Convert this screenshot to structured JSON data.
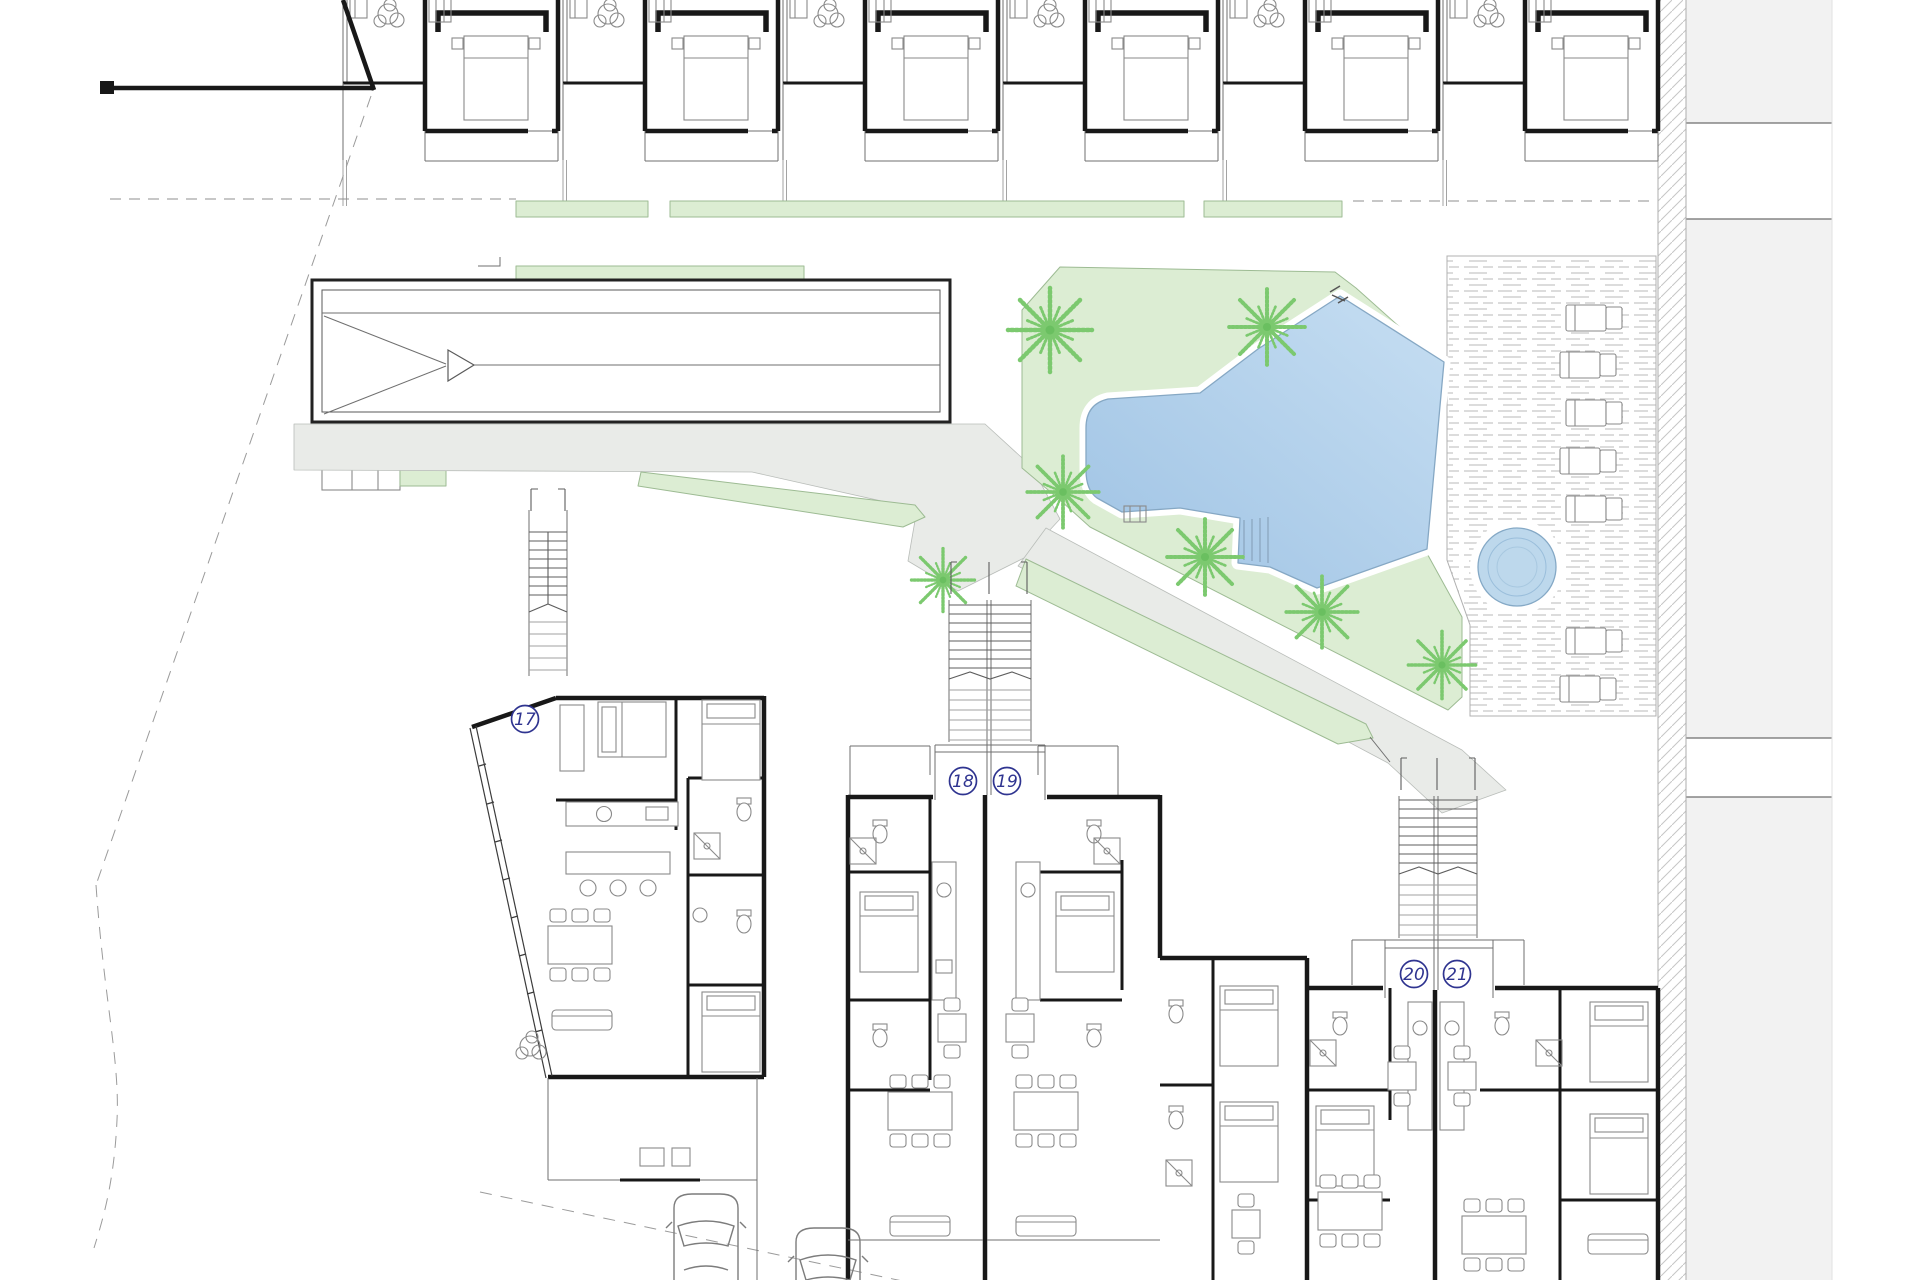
{
  "plan": {
    "unit_labels": [
      {
        "number": "17"
      },
      {
        "number": "18"
      },
      {
        "number": "19"
      },
      {
        "number": "20"
      },
      {
        "number": "21"
      }
    ]
  },
  "palette": {
    "lawn": "#dcedd3",
    "path": "#e9ebe8",
    "palm": "#7cc96f",
    "pool_light": "#c6def2",
    "pool_dark": "#9fc3e4",
    "spa": "#bdd8ec",
    "label_ink": "#2f3490",
    "wall_ink": "#181818",
    "deck_line": "#b9b9b9",
    "sidewalk": "#f2f2f2"
  }
}
